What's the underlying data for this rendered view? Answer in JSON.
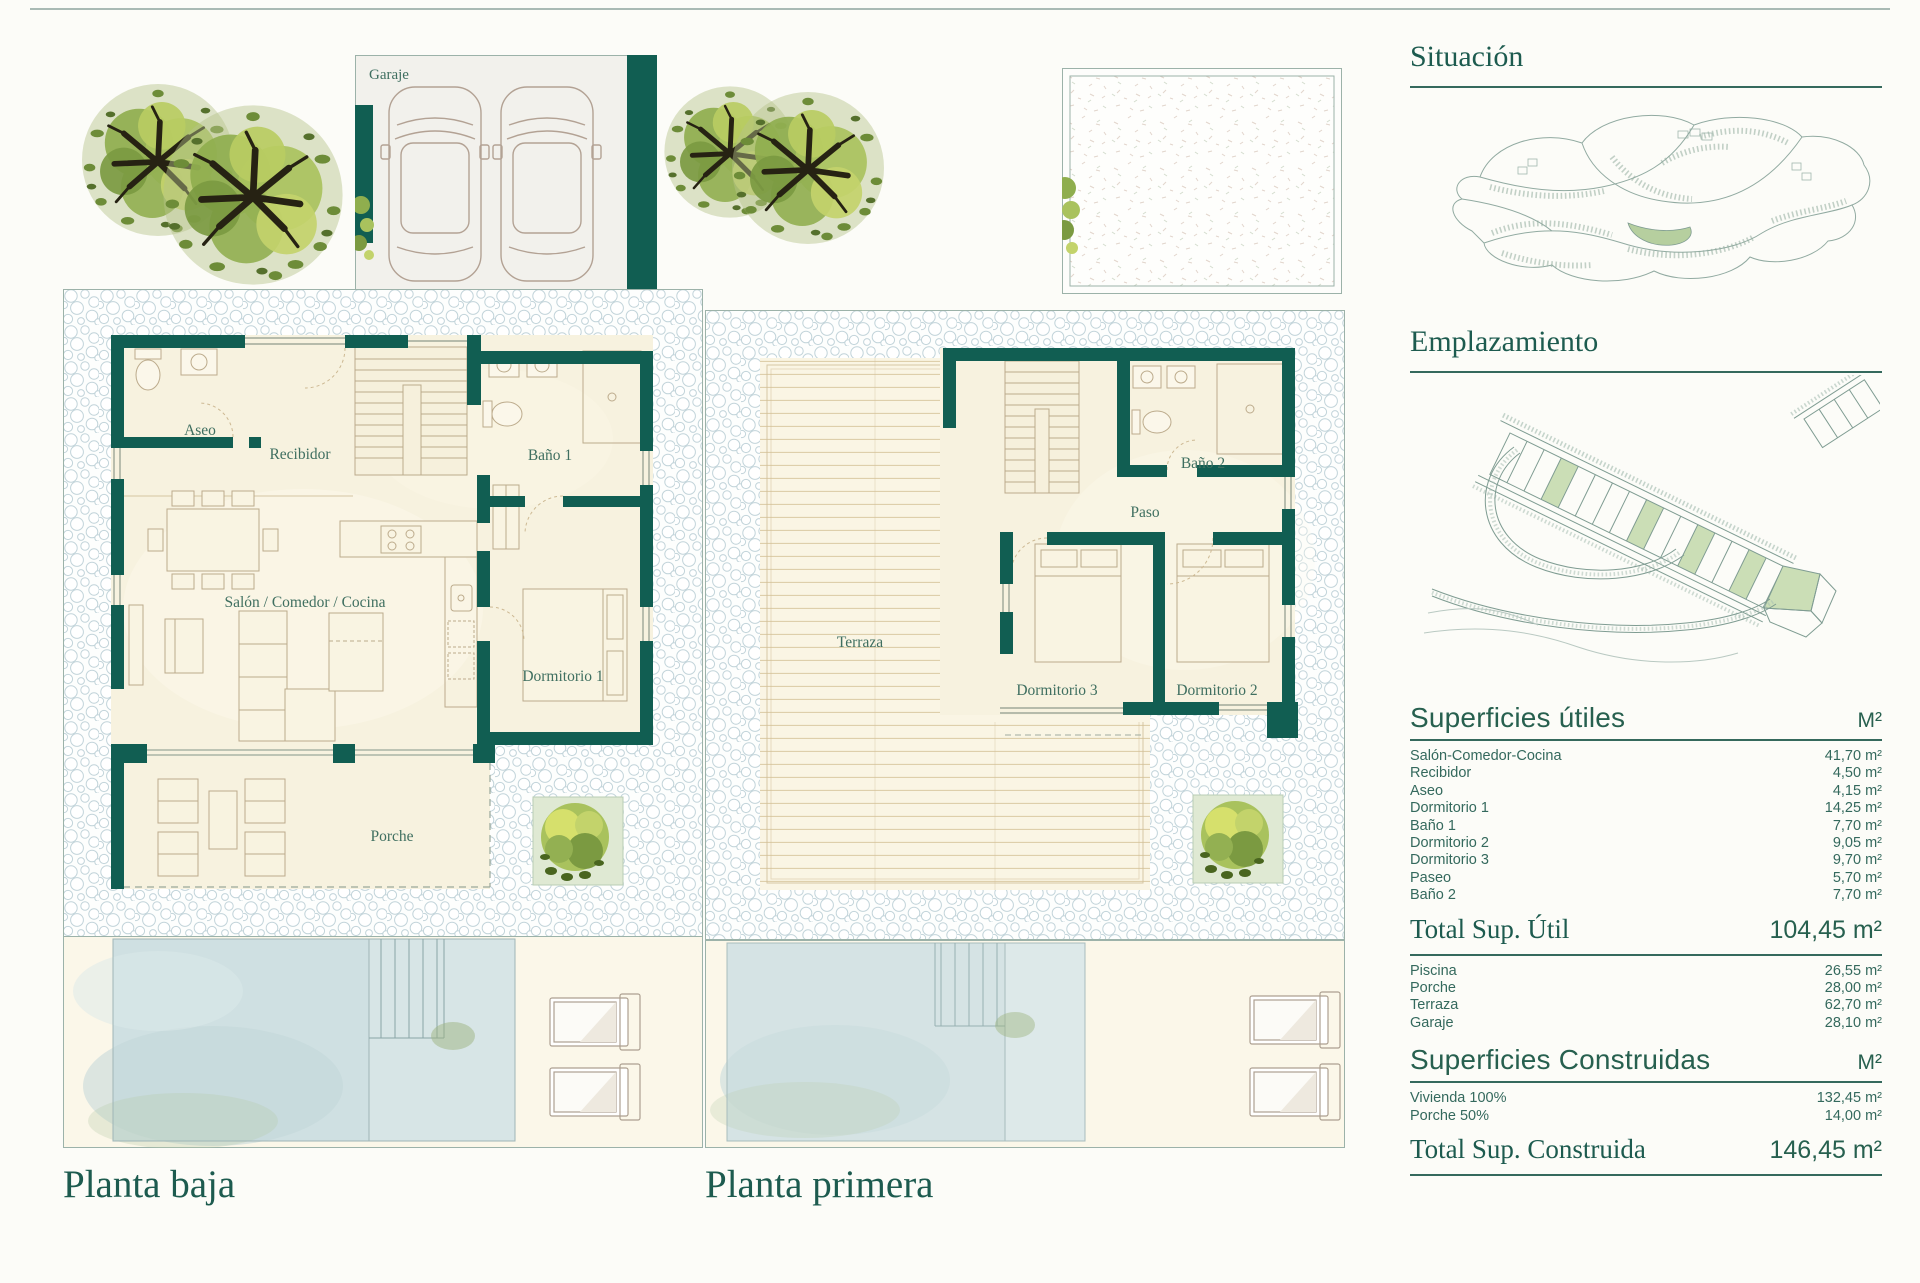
{
  "document": {
    "plan1": {
      "title": "Planta baja",
      "garage_label": "Garaje",
      "rooms": {
        "aseo": "Aseo",
        "recibidor": "Recibidor",
        "bano1": "Baño 1",
        "salon": "Salón / Comedor / Cocina",
        "dormitorio1": "Dormitorio 1",
        "porche": "Porche"
      }
    },
    "plan2": {
      "title": "Planta primera",
      "rooms": {
        "terraza": "Terraza",
        "bano2": "Baño 2",
        "paso": "Paso",
        "dormitorio3": "Dormitorio 3",
        "dormitorio2": "Dormitorio 2"
      }
    },
    "sidebar": {
      "situacion_title": "Situación",
      "emplazamiento_title": "Emplazamiento",
      "superficies_utiles": {
        "title": "Superficies útiles",
        "unit": "M²",
        "rows": [
          {
            "label": "Salón-Comedor-Cocina",
            "value": "41,70 m²"
          },
          {
            "label": "Recibidor",
            "value": "4,50 m²"
          },
          {
            "label": "Aseo",
            "value": "4,15 m²"
          },
          {
            "label": "Dormitorio 1",
            "value": "14,25 m²"
          },
          {
            "label": "Baño 1",
            "value": "7,70 m²"
          },
          {
            "label": "Dormitorio 2",
            "value": "9,05 m²"
          },
          {
            "label": "Dormitorio 3",
            "value": "9,70 m²"
          },
          {
            "label": "Paseo",
            "value": "5,70 m²"
          },
          {
            "label": "Baño 2",
            "value": "7,70 m²"
          }
        ],
        "total_label": "Total Sup. Útil",
        "total_value": "104,45 m²",
        "outdoor_rows": [
          {
            "label": "Piscina",
            "value": "26,55 m²"
          },
          {
            "label": "Porche",
            "value": "28,00 m²"
          },
          {
            "label": "Terraza",
            "value": "62,70 m²"
          },
          {
            "label": "Garaje",
            "value": "28,10 m²"
          }
        ]
      },
      "superficies_construidas": {
        "title": "Superficies Construidas",
        "unit": "M²",
        "rows": [
          {
            "label": "Vivienda 100%",
            "value": "132,45 m²"
          },
          {
            "label": "Porche 50%",
            "value": "14,00 m²"
          }
        ],
        "total_label": "Total Sup. Construida",
        "total_value": "146,45 m²"
      }
    },
    "colors": {
      "wall_teal": "#115e52",
      "heading_green": "#1d5b4f",
      "table_green": "#34695d",
      "cream": "#f7f2df",
      "pool_blue": "#cfe0e2",
      "plot_green": "#cbdeb6"
    }
  }
}
